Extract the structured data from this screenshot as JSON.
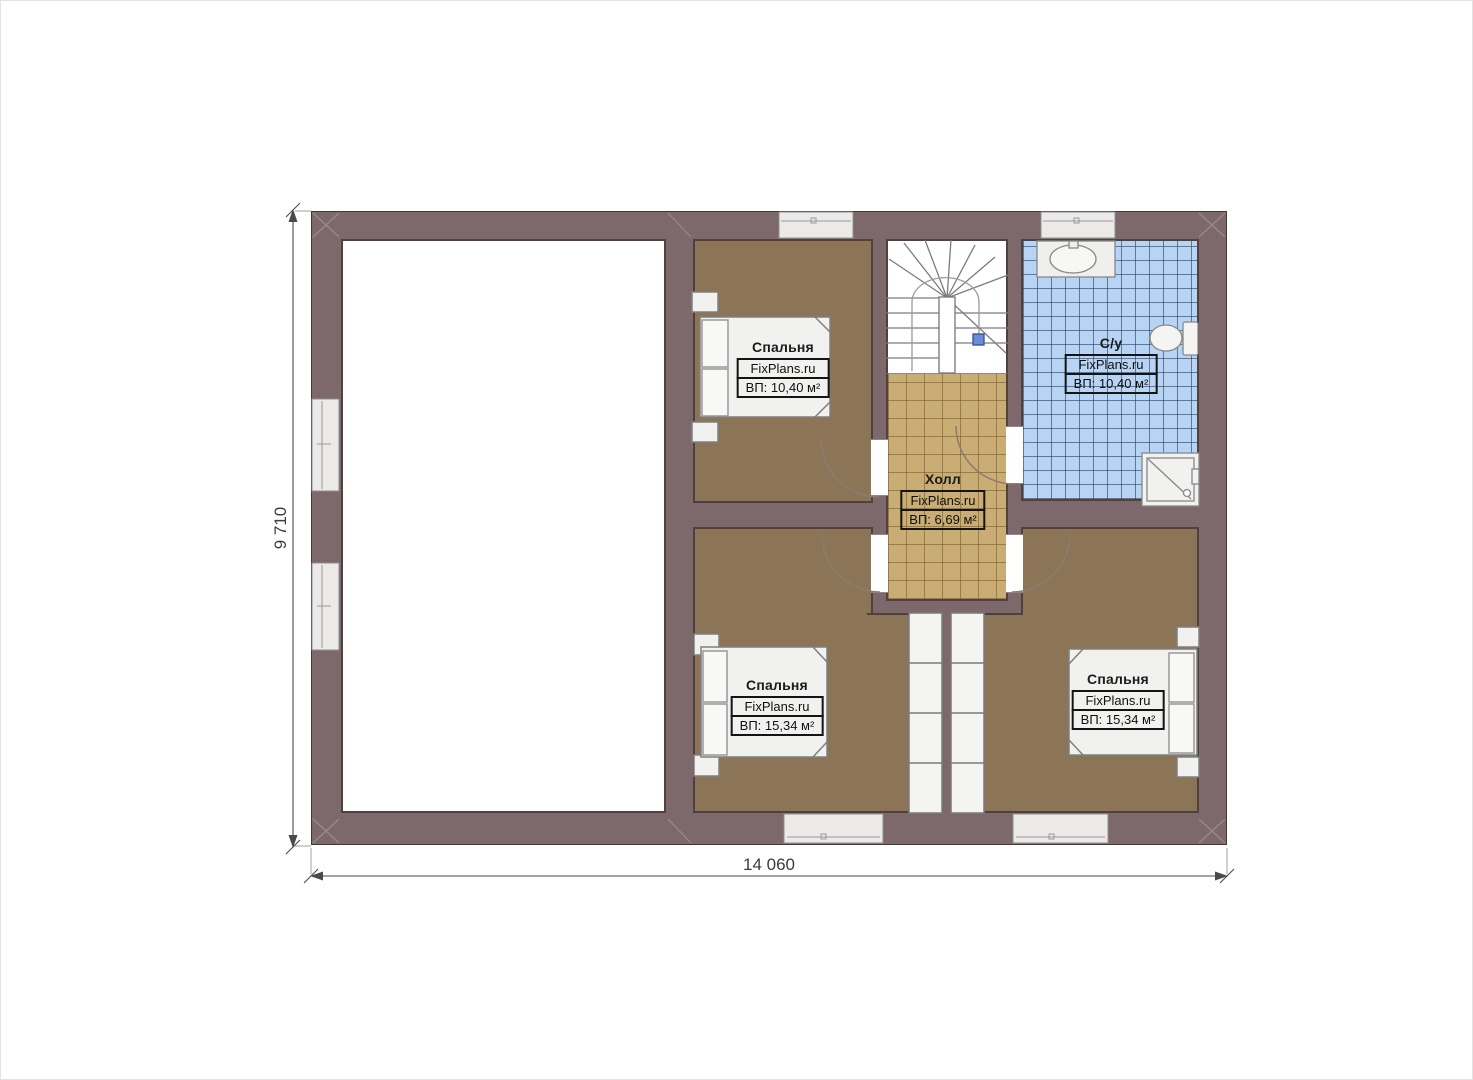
{
  "plan": {
    "dimension_width_label": "14 060",
    "dimension_height_label": "9 710"
  },
  "rooms": {
    "bedroom_top": {
      "name": "Спальня",
      "brand": "FixPlans.ru",
      "area": "ВП: 10,40 м²"
    },
    "bathroom": {
      "name": "С/у",
      "brand": "FixPlans.ru",
      "area": "ВП: 10,40 м²"
    },
    "hall": {
      "name": "Холл",
      "brand": "FixPlans.ru",
      "area": "ВП: 6,69 м²"
    },
    "bedroom_bottom_left": {
      "name": "Спальня",
      "brand": "FixPlans.ru",
      "area": "ВП: 15,34 м²"
    },
    "bedroom_bottom_right": {
      "name": "Спальня",
      "brand": "FixPlans.ru",
      "area": "ВП: 15,34 м²"
    }
  },
  "colors": {
    "wall": "#7d696b",
    "bedroom_floor": "#8c7557",
    "hall_floor": "#c9ad74",
    "bathroom_floor": "#b8d4f4",
    "window_fill": "#eceae8",
    "stair_marker_blue": "#6a8cd8",
    "dimension_text": "#3c3c3c"
  },
  "symbols": {
    "staircase": "staircase-symbol",
    "bed": "bed-symbol",
    "toilet": "toilet-symbol",
    "sink": "sink-symbol",
    "shower": "shower-symbol",
    "door": "door-arc-symbol",
    "window": "window-symbol",
    "wardrobe": "wardrobe-symbol"
  }
}
